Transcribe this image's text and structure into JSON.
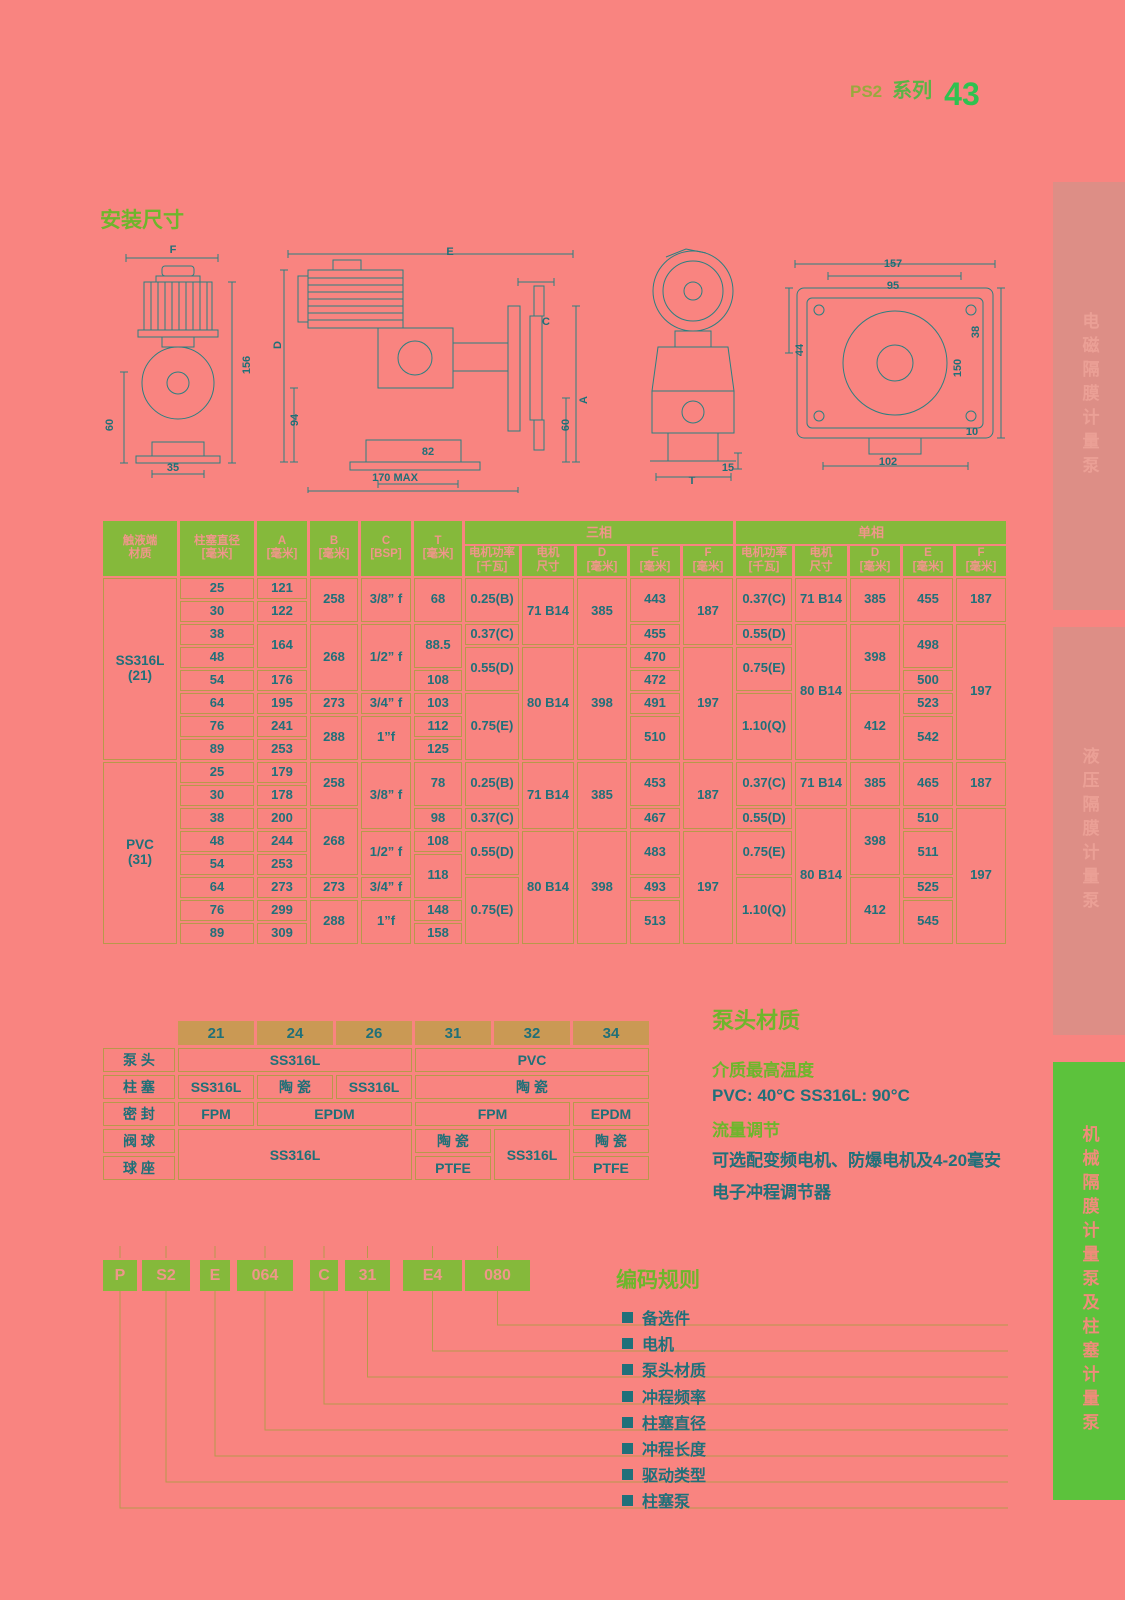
{
  "header": {
    "series_code": "PS2",
    "series_word": "系列",
    "page_number": "43"
  },
  "sections": {
    "install_title": "安装尺寸",
    "material_title": "泵头材质",
    "coding_title": "编码规则"
  },
  "drawing_labels": [
    {
      "t": "F",
      "x": 173,
      "y": 250
    },
    {
      "t": "60",
      "x": 110,
      "y": 425,
      "r": 1
    },
    {
      "t": "156",
      "x": 247,
      "y": 365,
      "r": 1
    },
    {
      "t": "35",
      "x": 173,
      "y": 468
    },
    {
      "t": "E",
      "x": 450,
      "y": 252
    },
    {
      "t": "D",
      "x": 278,
      "y": 345,
      "r": 1
    },
    {
      "t": "94",
      "x": 295,
      "y": 420,
      "r": 1
    },
    {
      "t": "C",
      "x": 546,
      "y": 322
    },
    {
      "t": "A",
      "x": 584,
      "y": 400,
      "r": 1
    },
    {
      "t": "60",
      "x": 566,
      "y": 425,
      "r": 1
    },
    {
      "t": "82",
      "x": 428,
      "y": 452
    },
    {
      "t": "170 MAX",
      "x": 395,
      "y": 478
    },
    {
      "t": "T",
      "x": 692,
      "y": 481
    },
    {
      "t": "15",
      "x": 728,
      "y": 468
    },
    {
      "t": "157",
      "x": 893,
      "y": 264
    },
    {
      "t": "95",
      "x": 893,
      "y": 286
    },
    {
      "t": "44",
      "x": 800,
      "y": 350,
      "r": 1
    },
    {
      "t": "38",
      "x": 976,
      "y": 332,
      "r": 1
    },
    {
      "t": "150",
      "x": 958,
      "y": 368,
      "r": 1
    },
    {
      "t": "10",
      "x": 972,
      "y": 432
    },
    {
      "t": "102",
      "x": 888,
      "y": 462
    }
  ],
  "dim_table": {
    "left_headers": [
      {
        "l1": "触液端",
        "l2": "材质"
      },
      {
        "l1": "柱塞直径",
        "l2": "[毫米]"
      },
      {
        "l1": "A",
        "l2": "[毫米]"
      },
      {
        "l1": "B",
        "l2": "[毫米]"
      },
      {
        "l1": "C",
        "l2": "[BSP]"
      },
      {
        "l1": "T",
        "l2": "[毫米]"
      }
    ],
    "groups": [
      {
        "label": "三相",
        "cols": [
          {
            "l1": "电机功率",
            "l2": "[千瓦]"
          },
          {
            "l1": "电机",
            "l2": "尺寸"
          },
          {
            "l1": "D",
            "l2": "[毫米]"
          },
          {
            "l1": "E",
            "l2": "[毫米]"
          },
          {
            "l1": "F",
            "l2": "[毫米]"
          }
        ]
      },
      {
        "label": "单相",
        "cols": [
          {
            "l1": "电机功率",
            "l2": "[千瓦]"
          },
          {
            "l1": "电机",
            "l2": "尺寸"
          },
          {
            "l1": "D",
            "l2": "[毫米]"
          },
          {
            "l1": "E",
            "l2": "[毫米]"
          },
          {
            "l1": "F",
            "l2": "[毫米]"
          }
        ]
      }
    ],
    "rows": [
      [
        {
          "v": "SS316L\n(21)",
          "rs": 8,
          "m": 1
        },
        {
          "v": "25"
        },
        {
          "v": "121"
        },
        {
          "v": "258",
          "rs": 2
        },
        {
          "v": "3/8” f",
          "rs": 2
        },
        {
          "v": "68",
          "rs": 2
        },
        {
          "v": "0.25(B)",
          "rs": 2
        },
        {
          "v": "71 B14",
          "rs": 3
        },
        {
          "v": "385",
          "rs": 3
        },
        {
          "v": "443",
          "rs": 2
        },
        {
          "v": "187",
          "rs": 3
        },
        {
          "v": "0.37(C)",
          "rs": 2
        },
        {
          "v": "71 B14",
          "rs": 2
        },
        {
          "v": "385",
          "rs": 2
        },
        {
          "v": "455",
          "rs": 2
        },
        {
          "v": "187",
          "rs": 2
        }
      ],
      [
        {
          "v": "30"
        },
        {
          "v": "122"
        }
      ],
      [
        {
          "v": "38"
        },
        {
          "v": "164",
          "rs": 2
        },
        {
          "v": "268",
          "rs": 3
        },
        {
          "v": "1/2” f",
          "rs": 3
        },
        {
          "v": "88.5",
          "rs": 2
        },
        {
          "v": "0.37(C)"
        },
        {
          "v": "455"
        },
        {
          "v": "0.55(D)"
        },
        {
          "v": "80 B14",
          "rs": 6
        },
        {
          "v": "398",
          "rs": 3
        },
        {
          "v": "498",
          "rs": 2
        },
        {
          "v": "197",
          "rs": 6
        }
      ],
      [
        {
          "v": "48"
        },
        {
          "v": "0.55(D)",
          "rs": 2
        },
        {
          "v": "80 B14",
          "rs": 5
        },
        {
          "v": "398",
          "rs": 5
        },
        {
          "v": "470"
        },
        {
          "v": "197",
          "rs": 5
        },
        {
          "v": "0.75(E)",
          "rs": 2
        }
      ],
      [
        {
          "v": "54"
        },
        {
          "v": "176"
        },
        {
          "v": "108"
        },
        {
          "v": "472"
        },
        {
          "v": "500"
        }
      ],
      [
        {
          "v": "64"
        },
        {
          "v": "195"
        },
        {
          "v": "273"
        },
        {
          "v": "3/4” f"
        },
        {
          "v": "103"
        },
        {
          "v": "0.75(E)",
          "rs": 3
        },
        {
          "v": "491"
        },
        {
          "v": "1.10(Q)",
          "rs": 3
        },
        {
          "v": "412",
          "rs": 3
        },
        {
          "v": "523"
        }
      ],
      [
        {
          "v": "76"
        },
        {
          "v": "241"
        },
        {
          "v": "288",
          "rs": 2
        },
        {
          "v": "1”f",
          "rs": 2
        },
        {
          "v": "112"
        },
        {
          "v": "510",
          "rs": 2
        },
        {
          "v": "542",
          "rs": 2
        }
      ],
      [
        {
          "v": "89"
        },
        {
          "v": "253"
        },
        {
          "v": "125"
        }
      ],
      [
        {
          "v": "PVC\n(31)",
          "rs": 8,
          "m": 1
        },
        {
          "v": "25"
        },
        {
          "v": "179"
        },
        {
          "v": "258",
          "rs": 2
        },
        {
          "v": "3/8” f",
          "rs": 3
        },
        {
          "v": "78",
          "rs": 2
        },
        {
          "v": "0.25(B)",
          "rs": 2
        },
        {
          "v": "71 B14",
          "rs": 3
        },
        {
          "v": "385",
          "rs": 3
        },
        {
          "v": "453",
          "rs": 2
        },
        {
          "v": "187",
          "rs": 3
        },
        {
          "v": "0.37(C)",
          "rs": 2
        },
        {
          "v": "71 B14",
          "rs": 2
        },
        {
          "v": "385",
          "rs": 2
        },
        {
          "v": "465",
          "rs": 2
        },
        {
          "v": "187",
          "rs": 2
        }
      ],
      [
        {
          "v": "30"
        },
        {
          "v": "178"
        }
      ],
      [
        {
          "v": "38"
        },
        {
          "v": "200"
        },
        {
          "v": "268",
          "rs": 3
        },
        {
          "v": "98"
        },
        {
          "v": "0.37(C)"
        },
        {
          "v": "467"
        },
        {
          "v": "0.55(D)"
        },
        {
          "v": "80 B14",
          "rs": 6
        },
        {
          "v": "398",
          "rs": 3
        },
        {
          "v": "510"
        },
        {
          "v": "197",
          "rs": 6
        }
      ],
      [
        {
          "v": "48"
        },
        {
          "v": "244"
        },
        {
          "v": "1/2” f",
          "rs": 2
        },
        {
          "v": "108"
        },
        {
          "v": "0.55(D)",
          "rs": 2
        },
        {
          "v": "80 B14",
          "rs": 5
        },
        {
          "v": "398",
          "rs": 5
        },
        {
          "v": "483",
          "rs": 2
        },
        {
          "v": "197",
          "rs": 5
        },
        {
          "v": "0.75(E)",
          "rs": 2
        },
        {
          "v": "511",
          "rs": 2
        }
      ],
      [
        {
          "v": "54"
        },
        {
          "v": "253"
        },
        {
          "v": "118",
          "rs": 2
        }
      ],
      [
        {
          "v": "64"
        },
        {
          "v": "273"
        },
        {
          "v": "273"
        },
        {
          "v": "3/4” f"
        },
        {
          "v": "0.75(E)",
          "rs": 3
        },
        {
          "v": "493"
        },
        {
          "v": "1.10(Q)",
          "rs": 3
        },
        {
          "v": "412",
          "rs": 3
        },
        {
          "v": "525"
        }
      ],
      [
        {
          "v": "76"
        },
        {
          "v": "299"
        },
        {
          "v": "288",
          "rs": 2
        },
        {
          "v": "1”f",
          "rs": 2
        },
        {
          "v": "148"
        },
        {
          "v": "513",
          "rs": 2
        },
        {
          "v": "545",
          "rs": 2
        }
      ],
      [
        {
          "v": "89"
        },
        {
          "v": "309"
        },
        {
          "v": "158"
        }
      ]
    ]
  },
  "material_table": {
    "col_headers": [
      "21",
      "24",
      "26",
      "31",
      "32",
      "34"
    ],
    "row_labels": [
      "泵 头",
      "柱 塞",
      "密 封",
      "阀 球",
      "球 座"
    ],
    "rows": [
      [
        {
          "v": "SS316L",
          "cs": 3
        },
        {
          "v": "PVC",
          "cs": 3
        }
      ],
      [
        {
          "v": "SS316L"
        },
        {
          "v": "陶 瓷"
        },
        {
          "v": "SS316L"
        },
        {
          "v": "陶 瓷",
          "cs": 3
        }
      ],
      [
        {
          "v": "FPM"
        },
        {
          "v": "EPDM",
          "cs": 2
        },
        {
          "v": "FPM",
          "cs": 2
        },
        {
          "v": "EPDM"
        }
      ],
      [
        {
          "v": "SS316L",
          "cs": 3,
          "rs": 2
        },
        {
          "v": "陶 瓷"
        },
        {
          "v": "SS316L",
          "rs": 2
        },
        {
          "v": "陶 瓷"
        }
      ],
      [
        {
          "v": "PTFE"
        },
        {
          "v": "PTFE"
        }
      ]
    ]
  },
  "info": {
    "temp_title": "介质最高温度",
    "temp_text": "PVC: 40°C    SS316L: 90°C",
    "flow_title": "流量调节",
    "flow_line1": "可选配变频电机、防爆电机及4-20毫安",
    "flow_line2": "电子冲程调节器"
  },
  "coding": {
    "boxes": [
      "P",
      "S2",
      "E",
      "064",
      "C",
      "31",
      "E4",
      "080"
    ],
    "labels": [
      "备选件",
      "电机",
      "泵头材质",
      "冲程频率",
      "柱塞直径",
      "冲程长度",
      "驱动类型",
      "柱塞泵"
    ]
  },
  "sidebar": [
    {
      "label": "电磁隔膜计量泵"
    },
    {
      "label": "液压隔膜计量泵"
    },
    {
      "label": "机械隔膜计量泵及柱塞计量泵"
    }
  ],
  "colors": {
    "background": "#f98480",
    "table_header_green": "#85b93b",
    "header_text_pink": "#f0968a",
    "cell_border_tan": "#b8984b",
    "value_teal": "#20707a",
    "title_green": "#6eb62c",
    "page_number_green": "#2fc250",
    "tab_muted": "#dd8e86",
    "tab_green": "#5cc23c",
    "material_header_tan": "#ca9954"
  }
}
